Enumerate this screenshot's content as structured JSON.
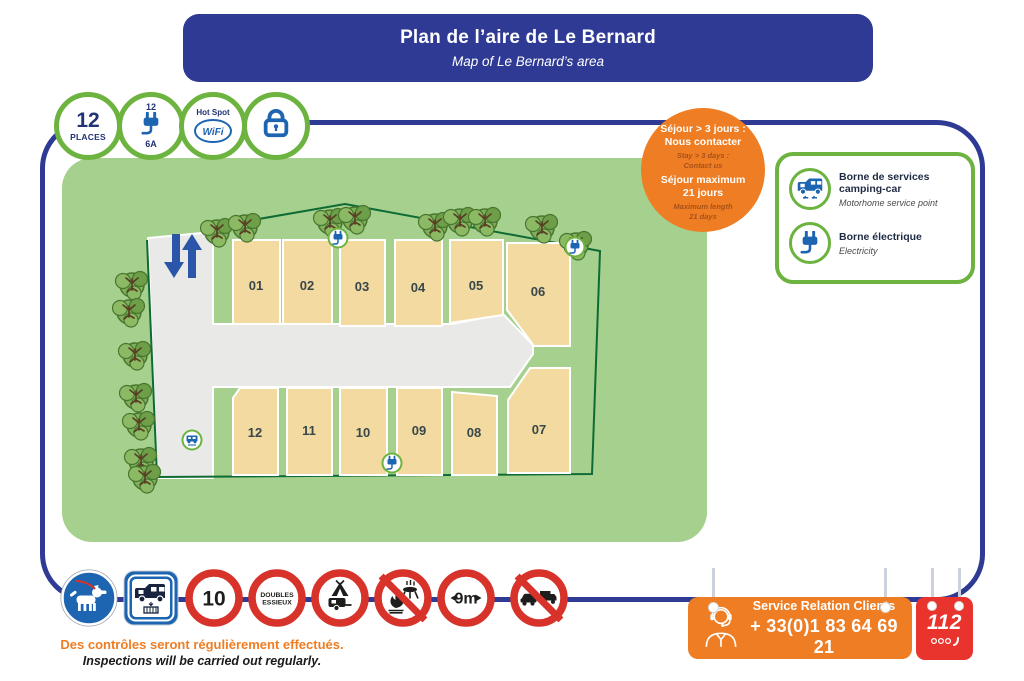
{
  "header": {
    "title": "Plan de l’aire de Le Bernard",
    "subtitle": "Map of Le Bernard’s area"
  },
  "top_icons": [
    {
      "type": "capacity",
      "value": "12",
      "label": "PLACES"
    },
    {
      "type": "power",
      "top": "12",
      "icon": "plug-icon",
      "bottom": "6A"
    },
    {
      "type": "wifi",
      "line1": "Hot Spot",
      "line2": "WiFi"
    },
    {
      "type": "security",
      "icon": "lock-icon"
    }
  ],
  "stay_badge": {
    "fr1": "Séjour > 3 jours :",
    "fr2": "Nous contacter",
    "en1": "Stay > 3 days :",
    "en2": "Contact us",
    "fr3": "Séjour maximum",
    "fr4": "21 jours",
    "en3": "Maximum length",
    "en4": "21 days"
  },
  "legend": {
    "items": [
      {
        "icon": "motorhome-icon",
        "title": "Borne de services camping-car",
        "subtitle": "Motorhome service point"
      },
      {
        "icon": "plug-icon",
        "title": "Borne électrique",
        "subtitle": "Electricity"
      }
    ]
  },
  "map": {
    "spot_labels": [
      "01",
      "02",
      "03",
      "04",
      "05",
      "06",
      "07",
      "08",
      "09",
      "10",
      "11",
      "12"
    ],
    "markers": [
      "electric",
      "electric",
      "electric",
      "service"
    ],
    "traffic": "two-way-arrows"
  },
  "signs": [
    {
      "type": "dog-on-leash-mandatory"
    },
    {
      "type": "motorhome-service-point"
    },
    {
      "type": "speed-limit",
      "text": "10"
    },
    {
      "type": "no-tandem-axles",
      "line1": "DOUBLES",
      "line2": "ESSIEUX"
    },
    {
      "type": "no-tents-caravans"
    },
    {
      "type": "no-fires-bbq"
    },
    {
      "type": "max-length",
      "text": "9m"
    },
    {
      "type": "no-cars-trucks"
    }
  ],
  "footnote": {
    "fr": "Des contrôles seront régulièrement effectués.",
    "en": "Inspections will be carried out regularly."
  },
  "contact": {
    "title": "Service Relation Clients",
    "phone": "+ 33(0)1 83 64 69 21"
  },
  "emergency": {
    "number": "112"
  },
  "colors": {
    "primary_blue": "#2e3a94",
    "icon_blue": "#1d64b1",
    "ring_green": "#6cb33f",
    "map_green": "#a6d08d",
    "fence_green": "#0e6b35",
    "road_grey": "#e9e9e7",
    "spot_tan": "#f3daa0",
    "orange": "#ee7d23",
    "sign_red": "#d8332a",
    "emergency_red": "#e8342c"
  }
}
